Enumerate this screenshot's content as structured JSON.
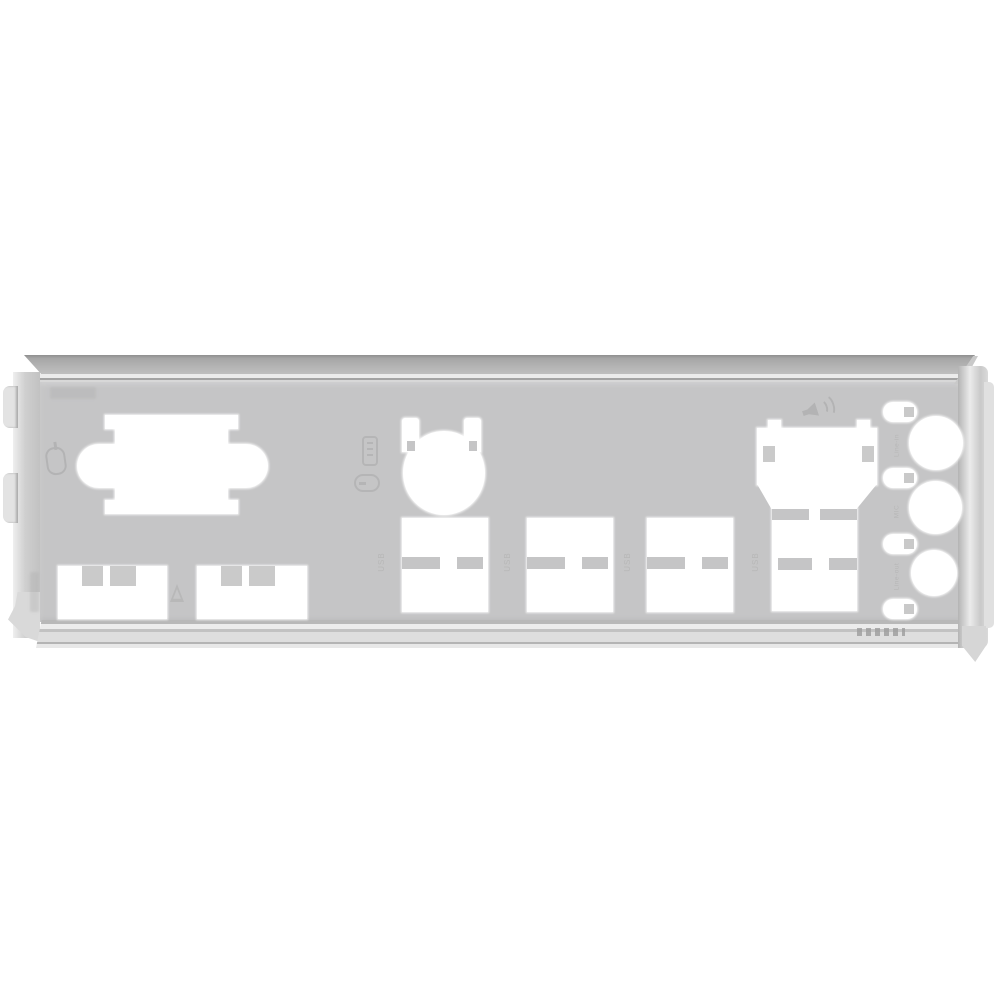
{
  "scene": {
    "type": "product-photo",
    "subject": "Motherboard rear I/O shield blanking plate",
    "description": "Light-gray stamped metal I/O shield on a plain white background, viewed straight on with folded top, bottom, left and right edges"
  },
  "colors": {
    "background": "#ffffff",
    "plate": "#c5c5c6",
    "cutout": "#ffffff",
    "fold_light": "#ececec",
    "fold_mid": "#b0b0b0",
    "fold_dark": "#8f8f8f",
    "emboss": "#a6a6a6",
    "label_text": "#b5b5b5"
  },
  "labels": {
    "usb_1": "USB",
    "usb_2": "USB",
    "usb_3": "USB",
    "usb_4": "USB",
    "audio_top": "Line-in",
    "audio_middle": "MIC",
    "audio_bottom": "Line-out"
  },
  "icons": {
    "mouse_icon": "embossed PS/2 mouse outline",
    "keyboard_icon": "embossed keyboard outline (rotated)",
    "mouse_icon_2": "embossed mouse outline (rotated)",
    "speaker_icon": "embossed speaker with sound waves",
    "triangle_icon": "embossed triangle mark"
  },
  "cutouts": {
    "ps2_combo": "PS/2 keyboard/mouse combo cutout",
    "usb_bottom_left_1": "USB type-A cutout",
    "usb_bottom_left_2": "USB type-A cutout",
    "ps2_round": "round PS/2-style connector cutout with spring prongs",
    "usb_stack_1": "dual USB type-A stack cutout",
    "usb_stack_2": "dual USB type-A stack cutout",
    "usb_stack_3": "dual USB type-A stack cutout",
    "lan_usb_stack": "RJ45 LAN over dual USB cutout",
    "audio_jacks": "three round 3.5mm audio jack cutouts with four retention slots"
  }
}
